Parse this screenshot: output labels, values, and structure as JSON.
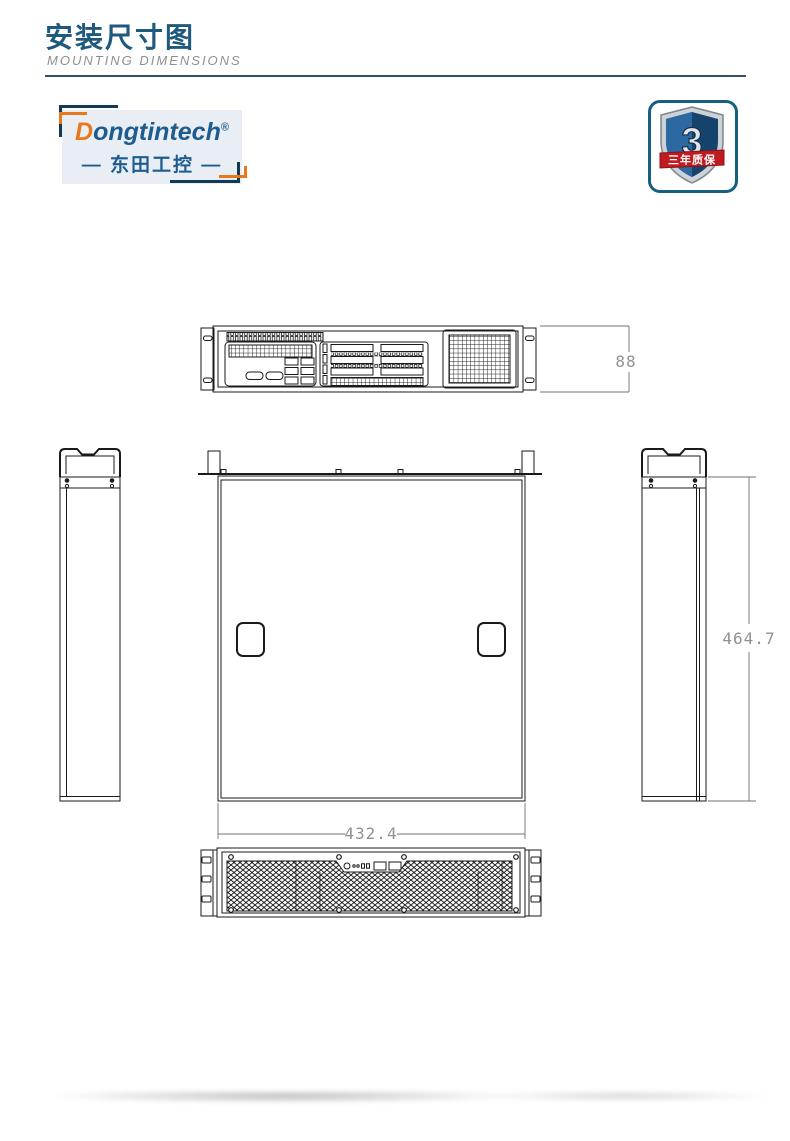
{
  "header": {
    "title": "安装尺寸图",
    "subtitle": "MOUNTING  DIMENSIONS"
  },
  "brand": {
    "name_initial": "D",
    "name_rest": "ongtintech",
    "registered_mark": "®",
    "name_zh_line": "— 东田工控 —"
  },
  "warranty_badge": {
    "number": "3",
    "label": "三年质保"
  },
  "drawing": {
    "dim_height": "88",
    "dim_depth": "464.7",
    "dim_width": "432.4"
  },
  "colors": {
    "title_blue": "#1f5a7d",
    "subtitle_gray": "#8f8f8f",
    "rule_blue": "#2e506c",
    "logo_blue": "#1d5c8f",
    "logo_orange": "#e8781e",
    "logo_bg": "#e9eef4",
    "badge_border": "#156080",
    "shield_dark_blue": "#16436b",
    "shield_light_blue": "#2d69a1",
    "ribbon_red": "#c01b20",
    "dimension_text_gray": "#8f9296",
    "drawing_line": "#1a1a1a"
  }
}
